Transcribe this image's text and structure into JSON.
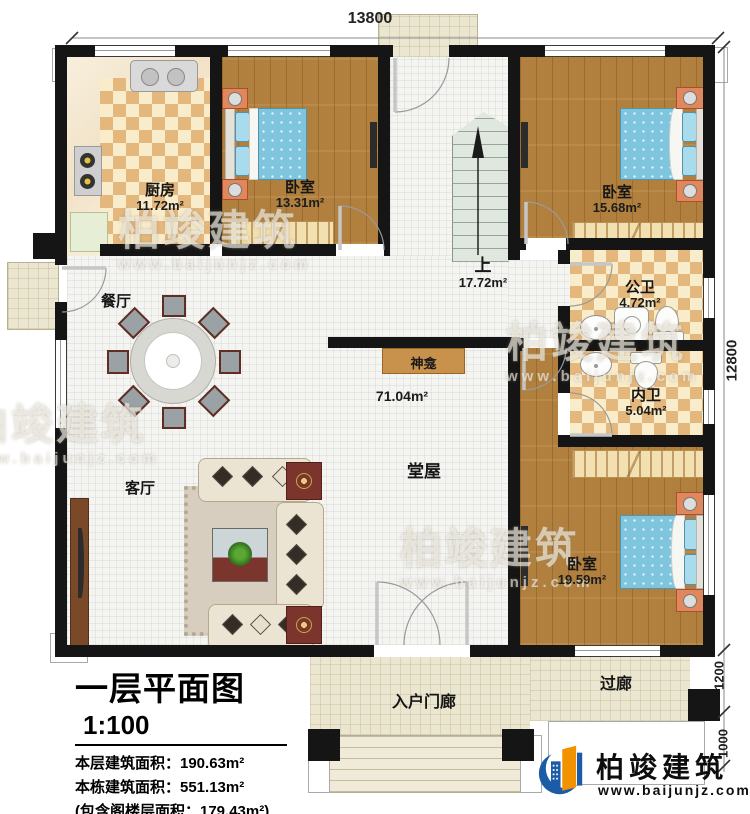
{
  "plan": {
    "title": "一层平面图",
    "scale": "1:100",
    "info_lines": [
      "本层建筑面积：190.63m²",
      "本栋建筑面积：551.13m²",
      "(包含阁楼层面积：179.43m²)",
      "占地面积：206.30m²　层高：3.9m"
    ]
  },
  "dimensions": {
    "top": "13800",
    "right_main": "12800",
    "right_corridor": "1200",
    "right_steps": "1000"
  },
  "rooms": {
    "kitchen": {
      "name": "厨房",
      "area": "11.72m²"
    },
    "bedroom1": {
      "name": "卧室",
      "area": "13.31m²"
    },
    "bedroom2": {
      "name": "卧室",
      "area": "15.68m²"
    },
    "bedroom3": {
      "name": "卧室",
      "area": "19.59m²"
    },
    "stairs": {
      "name": "上",
      "area": "17.72m²"
    },
    "public_bath": {
      "name": "公卫",
      "area": "4.72m²"
    },
    "private_bath": {
      "name": "内卫",
      "area": "5.04m²"
    },
    "hall": {
      "name": "堂屋",
      "area": "71.04m²"
    },
    "dining": {
      "name": "餐厅"
    },
    "living": {
      "name": "客厅"
    },
    "shrine": {
      "name": "神龛"
    },
    "entry_porch": {
      "name": "入户门廊"
    },
    "corridor": {
      "name": "过廊"
    }
  },
  "logo": {
    "name": "柏竣建筑",
    "url": "www.baijunjz.com"
  },
  "watermark": {
    "text": "柏竣建筑",
    "url": "www.baijunjz.com"
  },
  "colors": {
    "wall": "#151515",
    "wood_floor": "#b2803e",
    "checker_dark": "#e4b87c",
    "bed_blue": "#7fc5de",
    "logo_blue": "#1c5ba6",
    "logo_orange": "#f39200"
  }
}
